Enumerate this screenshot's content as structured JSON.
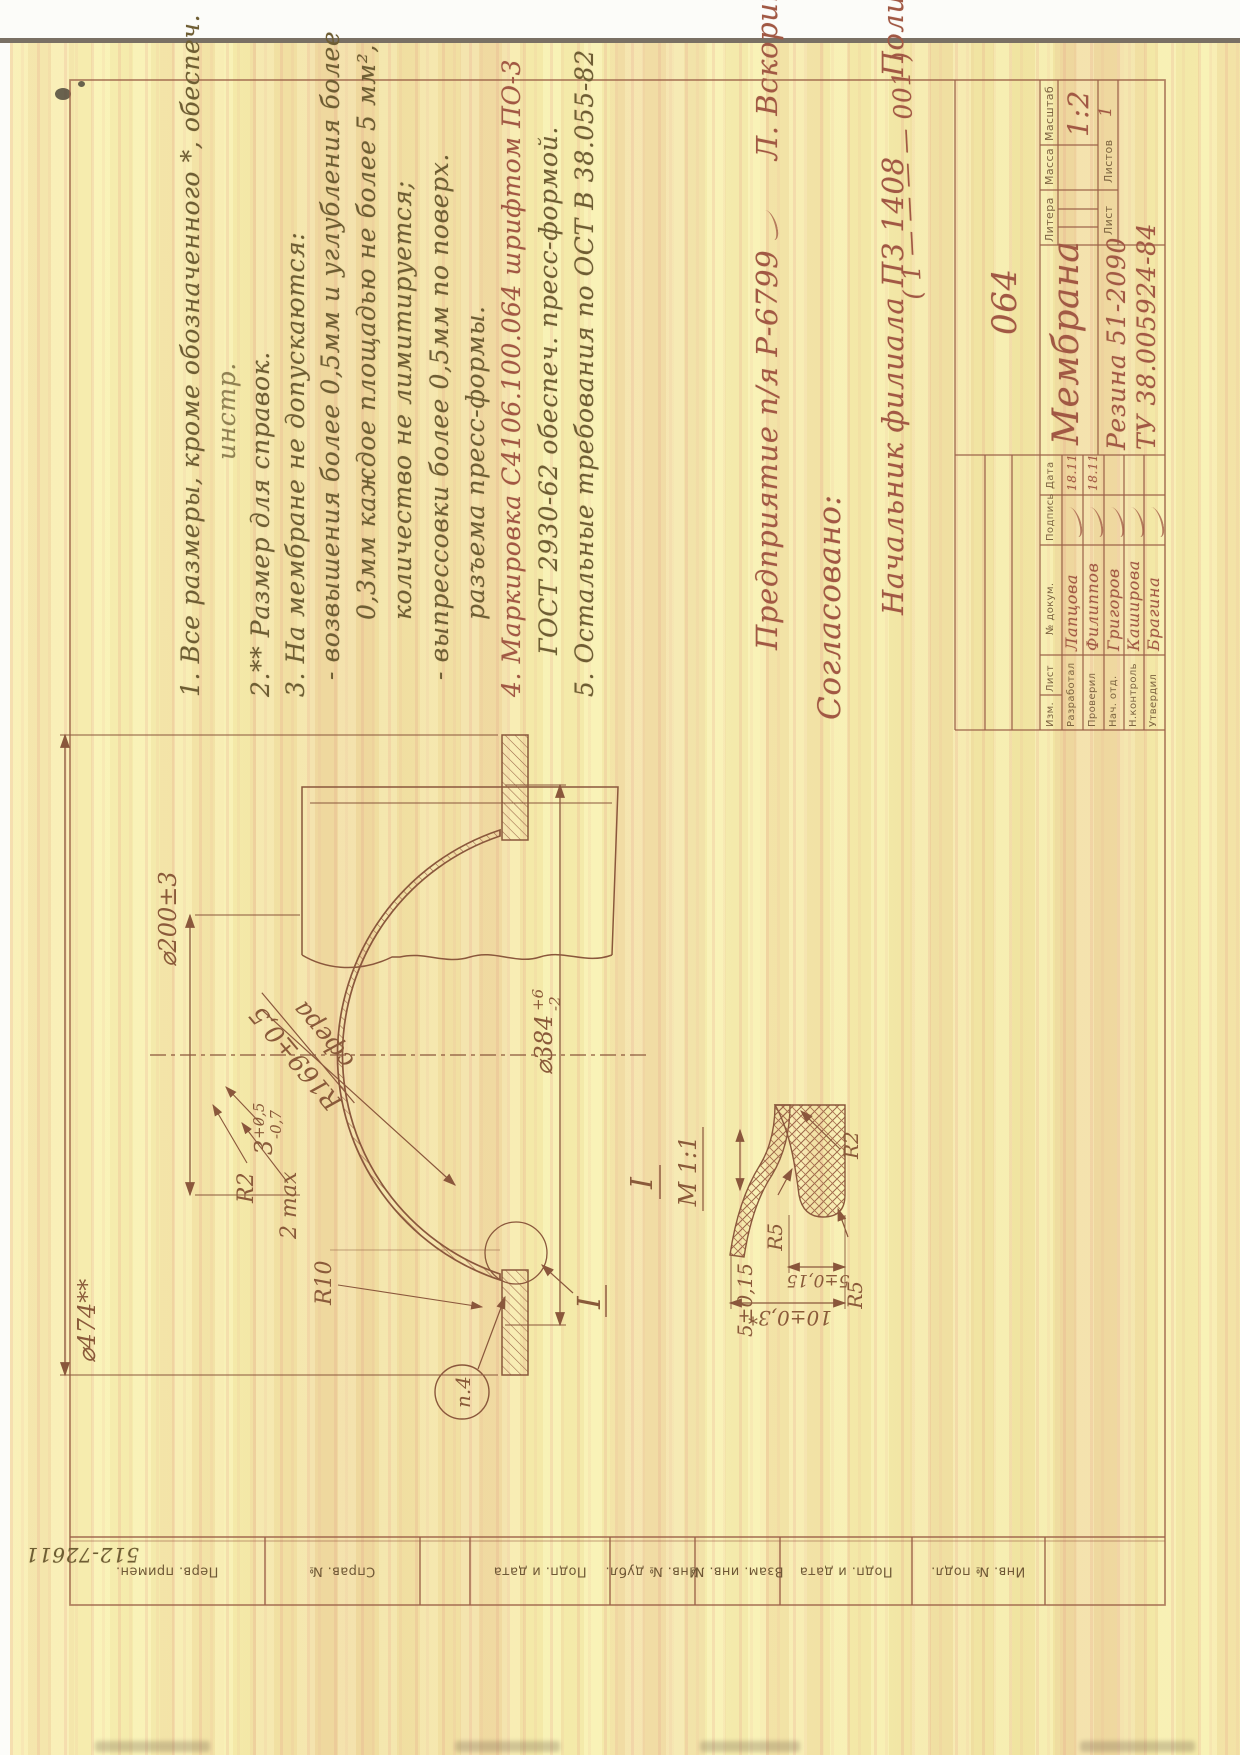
{
  "colors": {
    "paper": "#f3eba8",
    "streak_pink": "#e49686",
    "ink_olive": "#6e5d33",
    "ink_red": "#a15844",
    "line_brown": "#9a5f47"
  },
  "scan": {
    "handwritten_corner_number": "512-72611"
  },
  "margin_labels": {
    "perv_primen": "Перв. примен.",
    "sprav_no": "Справ. №",
    "podp_data1": "Подп. и дата",
    "inv_dubl": "Инв. № дубл.",
    "vzam_inv": "Взам. инв. №",
    "podp_data2": "Подп. и дата",
    "inv_podl": "Инв. № подл."
  },
  "notes": {
    "lines": [
      "1. Все размеры, кроме обозначенного *, обеспеч.",
      "инстр.",
      "2.** Размер для справок.",
      "3. На мембране не допускаются:",
      "- возвышения более 0,5мм и углубления более",
      "0,3мм каждое площадью не более 5 мм²,",
      "количество не лимитируется;",
      "- выпрессовки более 0,5мм по поверх.",
      "разъема пресс-формы.",
      "4. Маркировка  С4106.100.064  шрифтом  ПО-3",
      "ГОСТ 2930-62   обеспеч.  пресс-формой.",
      "5. Остальные  требования  по  ОСТ В 38.055-82"
    ]
  },
  "approval": {
    "line1": "Предприятие   п/я   Р-6799",
    "line1_sig": "Л. Вскорина",
    "header": "Согласовано:",
    "line2": "Начальник   филиала   ПЗ 1408",
    "line2_sig": "Полицеймако"
  },
  "title_block": {
    "designation_note": "( 1  — — — —  001 )",
    "designation": "064",
    "name": "Мембрана",
    "material_line1": "Резина 51-2090",
    "material_line2": "ТУ 38.005924-84",
    "litera_label": "Литера",
    "massa_label": "Масса",
    "masshtab_label": "Масштаб",
    "scale": "1:2",
    "list_label": "Лист",
    "listov_label": "Листов",
    "listov_value": "1",
    "stamp_headers": {
      "izm": "Изм.",
      "list": "Лист",
      "doc": "№ докум.",
      "podp": "Подпись",
      "data": "Дата"
    },
    "rows": [
      {
        "role": "Разработал",
        "name": "Лапцова",
        "date": "18.11"
      },
      {
        "role": "Проверил",
        "name": "Филиппов",
        "date": "18.11"
      },
      {
        "role": "Нач. отд.",
        "name": "Григоров",
        "date": ""
      },
      {
        "role": "Н.контроль",
        "name": "Каширова",
        "date": ""
      },
      {
        "role": "Утвердил",
        "name": "Брагина",
        "date": ""
      }
    ]
  },
  "drawing": {
    "dims": {
      "d474": "⌀474**",
      "d200": "⌀200±3",
      "r169": "R169±0,5",
      "sphere": "сфера",
      "t3": {
        "v": "3",
        "sup": "+0,5",
        "sub": "-0,7"
      },
      "d384": {
        "v": "⌀384",
        "sup": "+6",
        "sub": "-2"
      },
      "max2": "2 max",
      "r2": "R2",
      "r10": "R10",
      "p4": "п.4",
      "detail_ref": "I"
    },
    "detail": {
      "label": "I",
      "scale": "М 1:1",
      "d5a": "5±0,15",
      "r5a": "R5",
      "r2": "R2",
      "r5b": "R5",
      "d10": "10±0,3*",
      "d5b": "5±0,15"
    }
  }
}
